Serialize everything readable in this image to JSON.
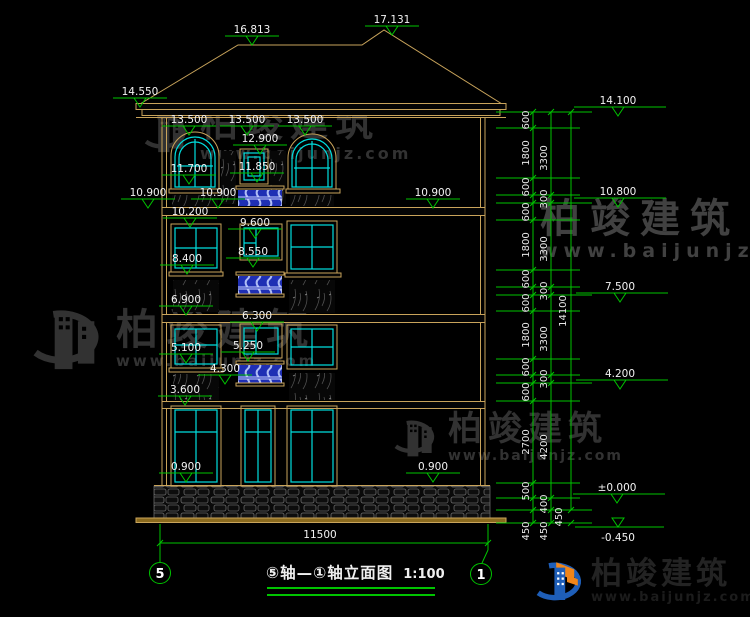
{
  "watermark": {
    "brand": "柏竣建筑",
    "url": "www.baijunjz.com"
  },
  "logo": {
    "brand": "柏竣建筑",
    "url": "www.baijunjz.com"
  },
  "title": {
    "text": "⑤轴—①轴立面图",
    "scale": "1:100"
  },
  "axes": {
    "left": "5",
    "right": "1"
  },
  "dims": {
    "bottom_width": "11500",
    "chain_a": [
      "600",
      "1800",
      "600",
      "600",
      "1800",
      "600",
      "600",
      "1800",
      "600",
      "600",
      "2700",
      "500",
      "450"
    ],
    "chain_b": [
      "3300",
      "300",
      "3300",
      "300",
      "3300",
      "300",
      "4200",
      "400",
      "450"
    ],
    "chain_c": [
      "14100",
      "450"
    ]
  },
  "elevations": {
    "ridge_left": "16.813",
    "ridge_right": "17.131",
    "eave": "14.550",
    "f4_head_l": "13.500",
    "f4_head_c": "13.500",
    "f4_head_r": "13.500",
    "f4_cwin_head": "12.900",
    "f4_cwin_sill": "11.850",
    "f4_sill": "11.700",
    "band4_l": "10.900",
    "band4_c": "10.900",
    "band4_r": "10.900",
    "band4_base": "10.200",
    "f3_cwin_head": "9.600",
    "f3_cwin_sill": "8.550",
    "f3_sill": "8.400",
    "floor3": "6.900",
    "f2_cwin_head": "6.300",
    "f2_cwin_sill": "5.250",
    "f2_sill": "5.100",
    "f2_rail": "4.300",
    "floor2": "3.600",
    "f1_sill_l": "0.900",
    "f1_sill_r": "0.900",
    "r_top": "14.100",
    "r_f4": "10.800",
    "r_f3": "7.500",
    "r_f2": "4.200",
    "r_zero": "±0.000",
    "r_base": "-0.450"
  }
}
